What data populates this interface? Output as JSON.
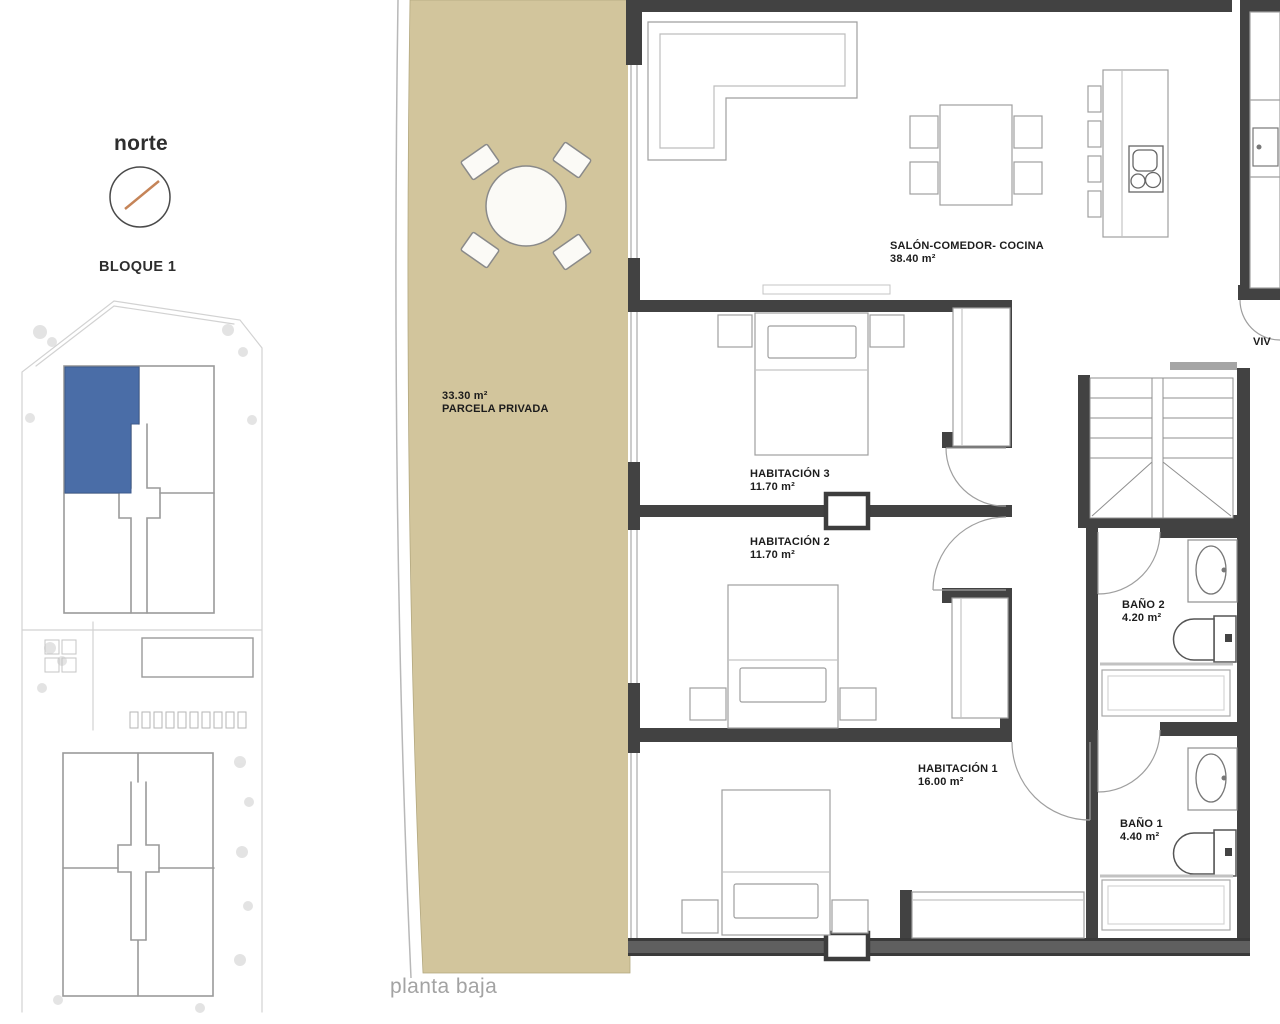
{
  "floor_caption": "planta baja",
  "compass": {
    "label": "norte"
  },
  "site_plan": {
    "title": "BLOQUE 1"
  },
  "terrace": {
    "area": "33.30 m²",
    "name": "PARCELA PRIVADA"
  },
  "rooms": {
    "salon": {
      "name": "SALÓN-COMEDOR- COCINA",
      "area": "38.40 m²"
    },
    "hab3": {
      "name": "HABITACIÓN 3",
      "area": "11.70 m²"
    },
    "hab2": {
      "name": "HABITACIÓN 2",
      "area": "11.70 m²"
    },
    "hab1": {
      "name": "HABITACIÓN 1",
      "area": "16.00 m²"
    },
    "bano2": {
      "name": "BAÑO 2",
      "area": "4.20 m²"
    },
    "bano1": {
      "name": "BAÑO 1",
      "area": "4.40 m²"
    }
  },
  "adjacent_label": "VIV",
  "colors": {
    "terrace": "#d2c59c",
    "highlight": "#4a6da7",
    "wall": "#424242",
    "compass-needle": "#bf7746"
  }
}
